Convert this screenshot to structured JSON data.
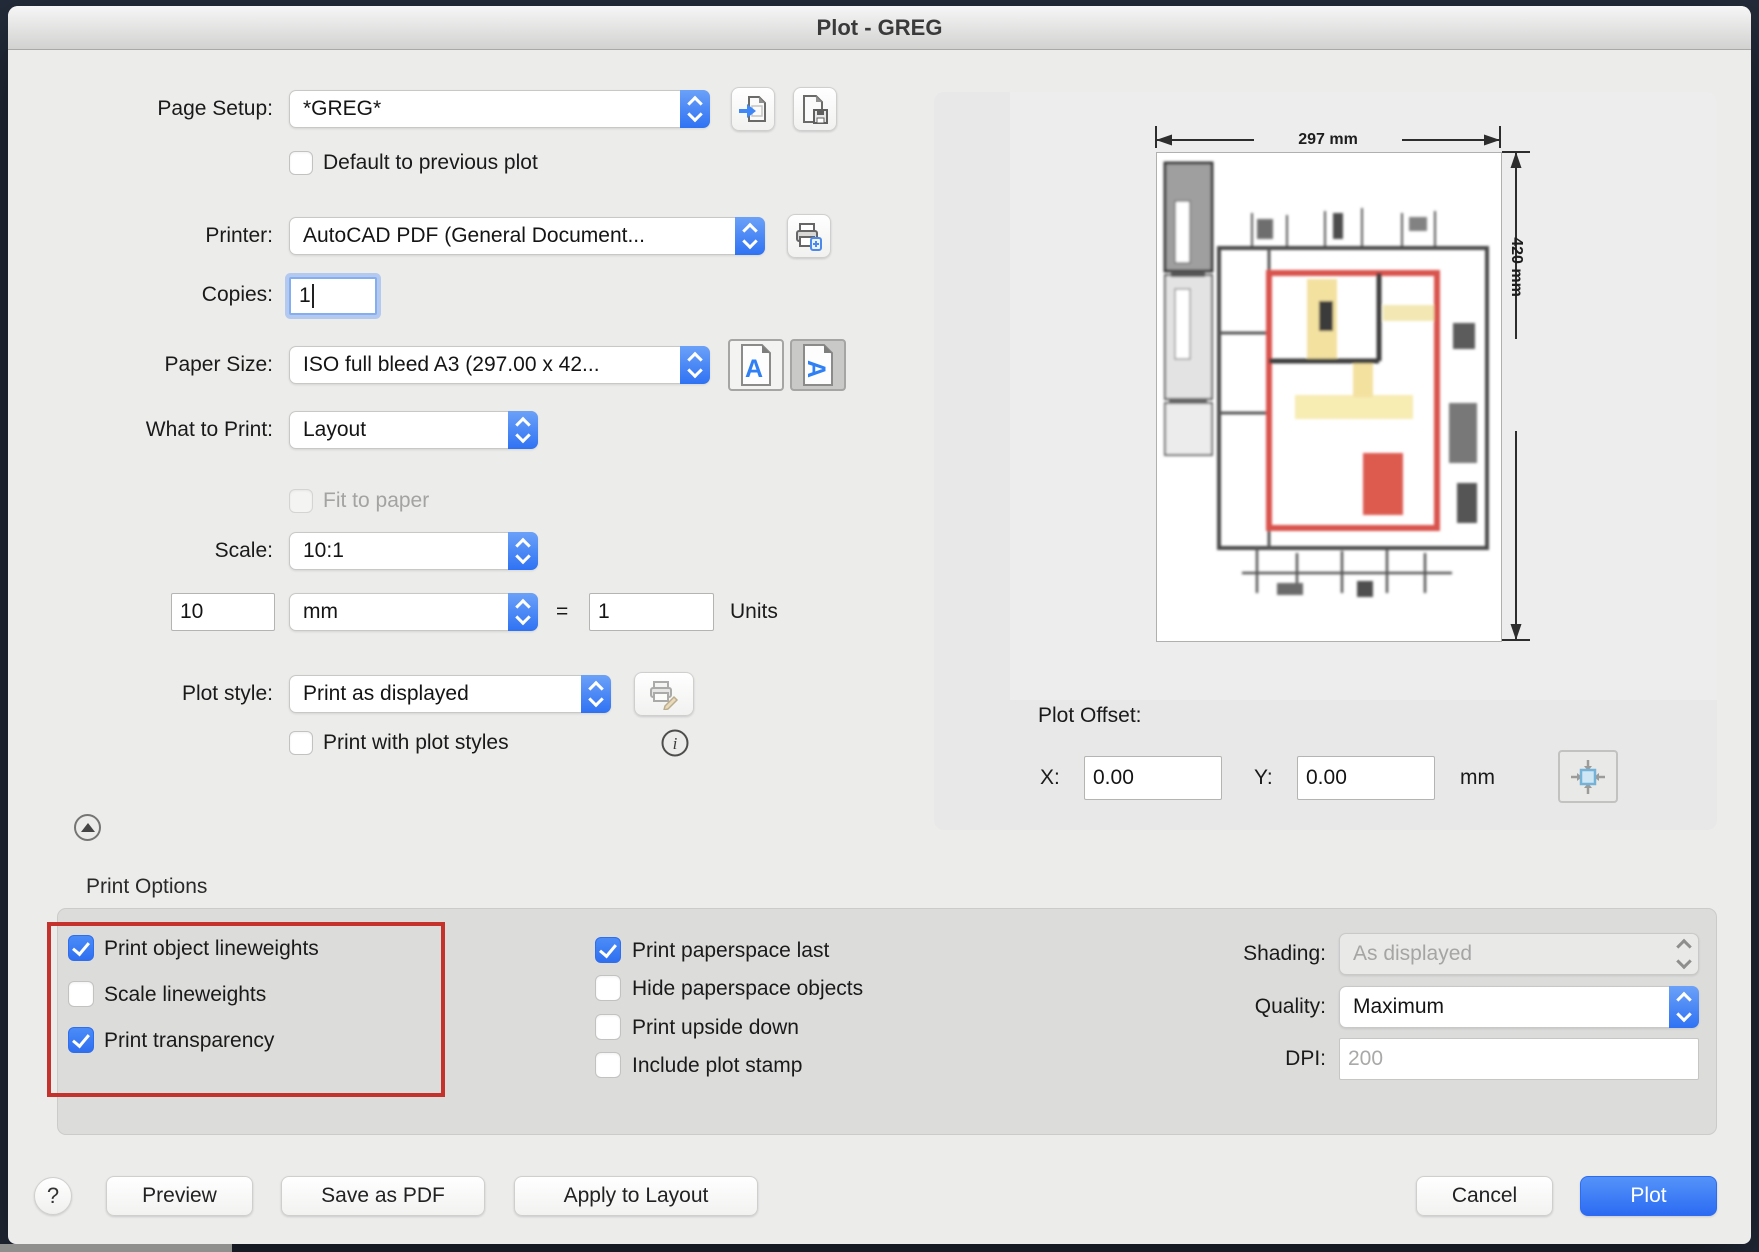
{
  "window": {
    "title": "Plot - GREG"
  },
  "page_setup": {
    "label": "Page Setup:",
    "value": "*GREG*"
  },
  "default_to_previous": {
    "label": "Default to previous plot",
    "checked": "false"
  },
  "printer": {
    "label": "Printer:",
    "value": "AutoCAD PDF (General Document..."
  },
  "copies": {
    "label": "Copies:",
    "value": "1"
  },
  "paper_size": {
    "label": "Paper Size:",
    "value": "ISO full bleed A3 (297.00 x 42..."
  },
  "what_to_print": {
    "label": "What to Print:",
    "value": "Layout"
  },
  "fit_to_paper": {
    "label": "Fit to paper",
    "checked": "false"
  },
  "scale": {
    "label": "Scale:",
    "value": "10:1"
  },
  "custom_scale": {
    "paper_value": "10",
    "unit": "mm",
    "equals": "=",
    "drawing_value": "1",
    "units_label": "Units"
  },
  "plot_style": {
    "label": "Plot style:",
    "value": "Print as displayed"
  },
  "print_with_plot_styles": {
    "label": "Print with plot styles",
    "checked": "false"
  },
  "preview": {
    "width_dim": "297 mm",
    "height_dim": "420 mm"
  },
  "plot_offset": {
    "label": "Plot Offset:",
    "x_label": "X:",
    "x_value": "0.00",
    "y_label": "Y:",
    "y_value": "0.00",
    "unit": "mm"
  },
  "print_options": {
    "section_label": "Print Options",
    "col1": [
      {
        "label": "Print object lineweights",
        "checked": "true"
      },
      {
        "label": "Scale lineweights",
        "checked": "false"
      },
      {
        "label": "Print transparency",
        "checked": "true"
      }
    ],
    "col2": [
      {
        "label": "Print paperspace last",
        "checked": "true"
      },
      {
        "label": "Hide paperspace objects",
        "checked": "false"
      },
      {
        "label": "Print upside down",
        "checked": "false"
      },
      {
        "label": "Include plot stamp",
        "checked": "false"
      }
    ],
    "shading": {
      "label": "Shading:",
      "value": "As displayed"
    },
    "quality": {
      "label": "Quality:",
      "value": "Maximum"
    },
    "dpi": {
      "label": "DPI:",
      "value": "200"
    }
  },
  "footer": {
    "help_label": "?",
    "preview_label": "Preview",
    "save_pdf_label": "Save as PDF",
    "apply_layout_label": "Apply to Layout",
    "cancel_label": "Cancel",
    "plot_label": "Plot"
  },
  "colors": {
    "accent": "#3679f6",
    "annotation_red": "#c5322c"
  }
}
